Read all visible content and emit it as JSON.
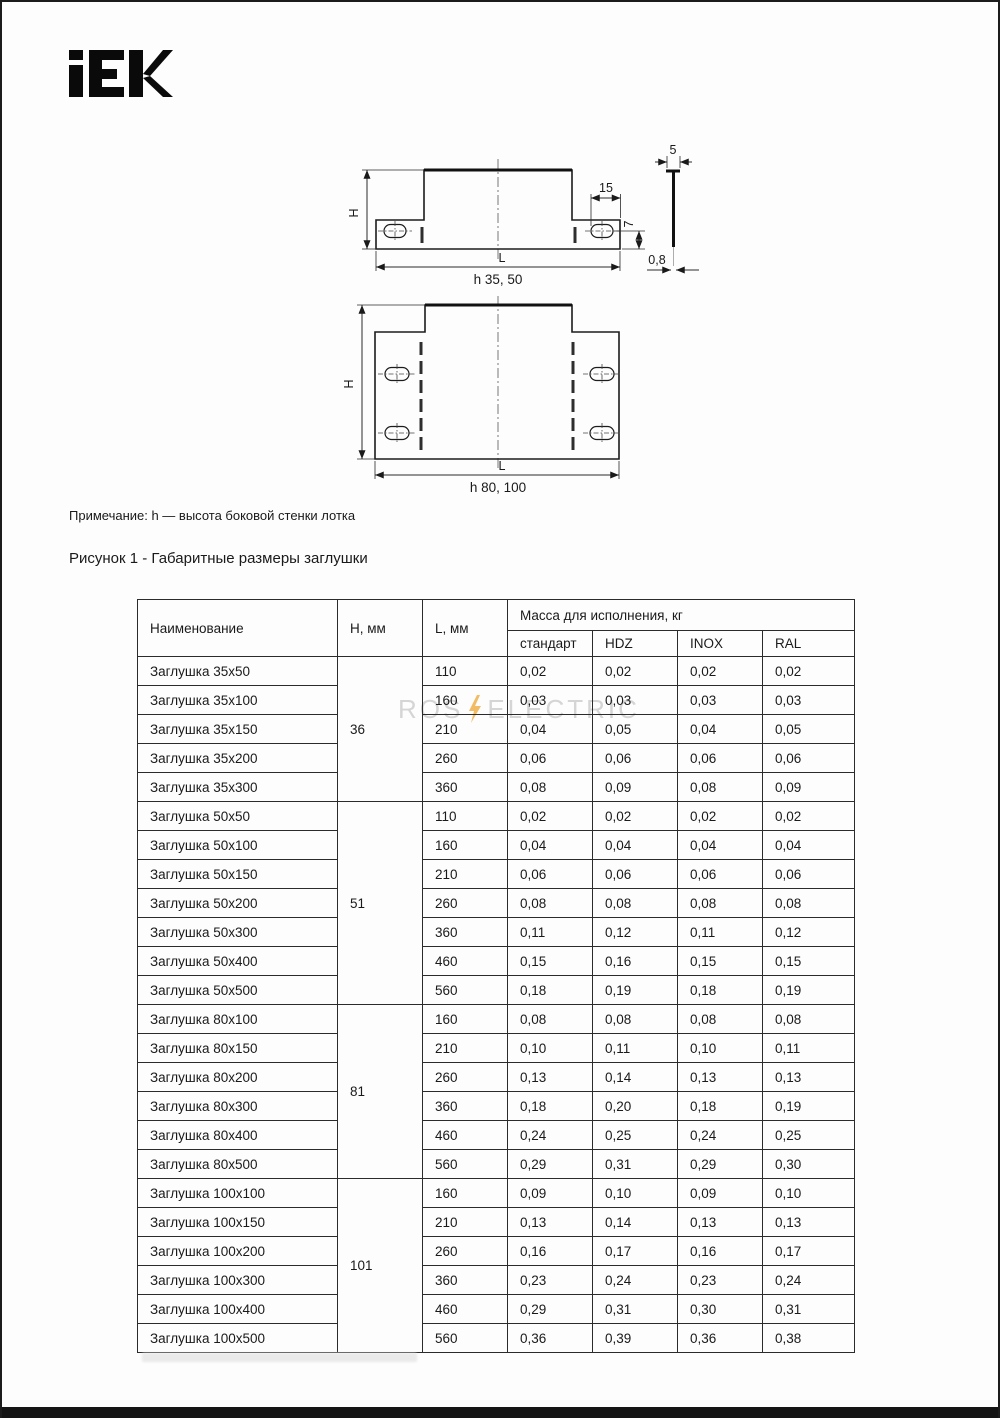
{
  "brand": {
    "logo_text": "IEK"
  },
  "figures": {
    "note": "Примечание: h — высота боковой стенки лотка",
    "caption": "Рисунок 1 - Габаритные размеры заглушки",
    "fig1": {
      "h_label": "H",
      "l_label": "L",
      "dim_15": "15",
      "dim_7": "7",
      "dim_5": "5",
      "dim_0_8": "0,8",
      "subcaption": "h 35, 50"
    },
    "fig2": {
      "h_label": "H",
      "l_label": "L",
      "subcaption": "h 80, 100"
    }
  },
  "watermark": {
    "left": "ROS",
    "right": "ELECTRIC",
    "text_color": "#d5d5d5",
    "bolt_color": "#f0b04a"
  },
  "table": {
    "col_name": "Наименование",
    "col_h": "H, мм",
    "col_l": "L, мм",
    "mass_header": "Масса для исполнения, кг",
    "mass_columns": [
      "стандарт",
      "HDZ",
      "INOX",
      "RAL"
    ],
    "rows": [
      {
        "name": "Заглушка 35x50",
        "h": "36",
        "h_span": 5,
        "l": "110",
        "mass": [
          "0,02",
          "0,02",
          "0,02",
          "0,02"
        ]
      },
      {
        "name": "Заглушка 35x100",
        "l": "160",
        "mass": [
          "0,03",
          "0,03",
          "0,03",
          "0,03"
        ]
      },
      {
        "name": "Заглушка 35x150",
        "l": "210",
        "mass": [
          "0,04",
          "0,05",
          "0,04",
          "0,05"
        ]
      },
      {
        "name": "Заглушка 35x200",
        "l": "260",
        "mass": [
          "0,06",
          "0,06",
          "0,06",
          "0,06"
        ]
      },
      {
        "name": "Заглушка 35x300",
        "l": "360",
        "mass": [
          "0,08",
          "0,09",
          "0,08",
          "0,09"
        ]
      },
      {
        "name": "Заглушка 50x50",
        "h": "51",
        "h_span": 7,
        "l": "110",
        "mass": [
          "0,02",
          "0,02",
          "0,02",
          "0,02"
        ]
      },
      {
        "name": "Заглушка 50x100",
        "l": "160",
        "mass": [
          "0,04",
          "0,04",
          "0,04",
          "0,04"
        ]
      },
      {
        "name": "Заглушка 50x150",
        "l": "210",
        "mass": [
          "0,06",
          "0,06",
          "0,06",
          "0,06"
        ]
      },
      {
        "name": "Заглушка 50x200",
        "l": "260",
        "mass": [
          "0,08",
          "0,08",
          "0,08",
          "0,08"
        ]
      },
      {
        "name": "Заглушка 50x300",
        "l": "360",
        "mass": [
          "0,11",
          "0,12",
          "0,11",
          "0,12"
        ]
      },
      {
        "name": "Заглушка 50x400",
        "l": "460",
        "mass": [
          "0,15",
          "0,16",
          "0,15",
          "0,15"
        ]
      },
      {
        "name": "Заглушка 50x500",
        "l": "560",
        "mass": [
          "0,18",
          "0,19",
          "0,18",
          "0,19"
        ]
      },
      {
        "name": "Заглушка 80x100",
        "h": "81",
        "h_span": 6,
        "l": "160",
        "mass": [
          "0,08",
          "0,08",
          "0,08",
          "0,08"
        ]
      },
      {
        "name": "Заглушка 80x150",
        "l": "210",
        "mass": [
          "0,10",
          "0,11",
          "0,10",
          "0,11"
        ]
      },
      {
        "name": "Заглушка 80x200",
        "l": "260",
        "mass": [
          "0,13",
          "0,14",
          "0,13",
          "0,13"
        ]
      },
      {
        "name": "Заглушка 80x300",
        "l": "360",
        "mass": [
          "0,18",
          "0,20",
          "0,18",
          "0,19"
        ]
      },
      {
        "name": "Заглушка 80x400",
        "l": "460",
        "mass": [
          "0,24",
          "0,25",
          "0,24",
          "0,25"
        ]
      },
      {
        "name": "Заглушка 80x500",
        "l": "560",
        "mass": [
          "0,29",
          "0,31",
          "0,29",
          "0,30"
        ]
      },
      {
        "name": "Заглушка 100x100",
        "h": "101",
        "h_span": 6,
        "l": "160",
        "mass": [
          "0,09",
          "0,10",
          "0,09",
          "0,10"
        ]
      },
      {
        "name": "Заглушка 100x150",
        "l": "210",
        "mass": [
          "0,13",
          "0,14",
          "0,13",
          "0,13"
        ]
      },
      {
        "name": "Заглушка 100x200",
        "l": "260",
        "mass": [
          "0,16",
          "0,17",
          "0,16",
          "0,17"
        ]
      },
      {
        "name": "Заглушка 100x300",
        "l": "360",
        "mass": [
          "0,23",
          "0,24",
          "0,23",
          "0,24"
        ]
      },
      {
        "name": "Заглушка 100x400",
        "l": "460",
        "mass": [
          "0,29",
          "0,31",
          "0,30",
          "0,31"
        ]
      },
      {
        "name": "Заглушка 100x500",
        "l": "560",
        "mass": [
          "0,36",
          "0,39",
          "0,36",
          "0,38"
        ]
      }
    ]
  }
}
